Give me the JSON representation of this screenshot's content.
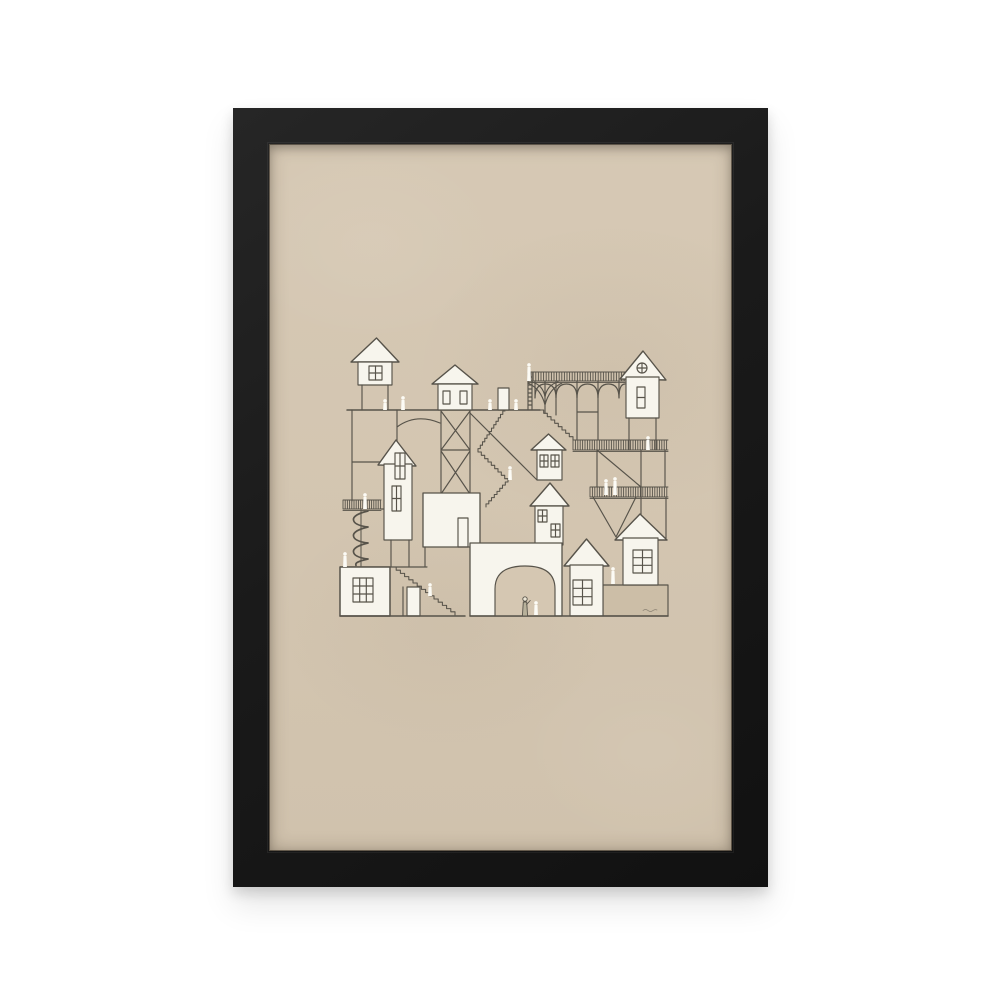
{
  "page": {
    "background_color": "#ffffff"
  },
  "product": {
    "type_label": "Framed art print product photo",
    "frame": {
      "color": "#1a1a1a",
      "border_width_px": 36,
      "style": "slim black frame"
    },
    "paper": {
      "color": "#d5c7b2"
    },
    "artwork": {
      "caption": "Hand-drawn illustration of a whimsical vertical village: white gabled houses stacked on stilts and platforms, connected by zigzag staircases, a ladder, railed walkways, an arched viaduct, a spiral staircase and an arched gateway, with tiny white figures throughout.",
      "ink_color": "#57534a",
      "building_fill": "#f7f5ed",
      "figure_fill": "#fcfbf5",
      "shaded_wall_fill": "#ccbea7",
      "building_count": 11,
      "figure_count": 15,
      "signature_note": "illegible artist signature, lower right"
    }
  }
}
